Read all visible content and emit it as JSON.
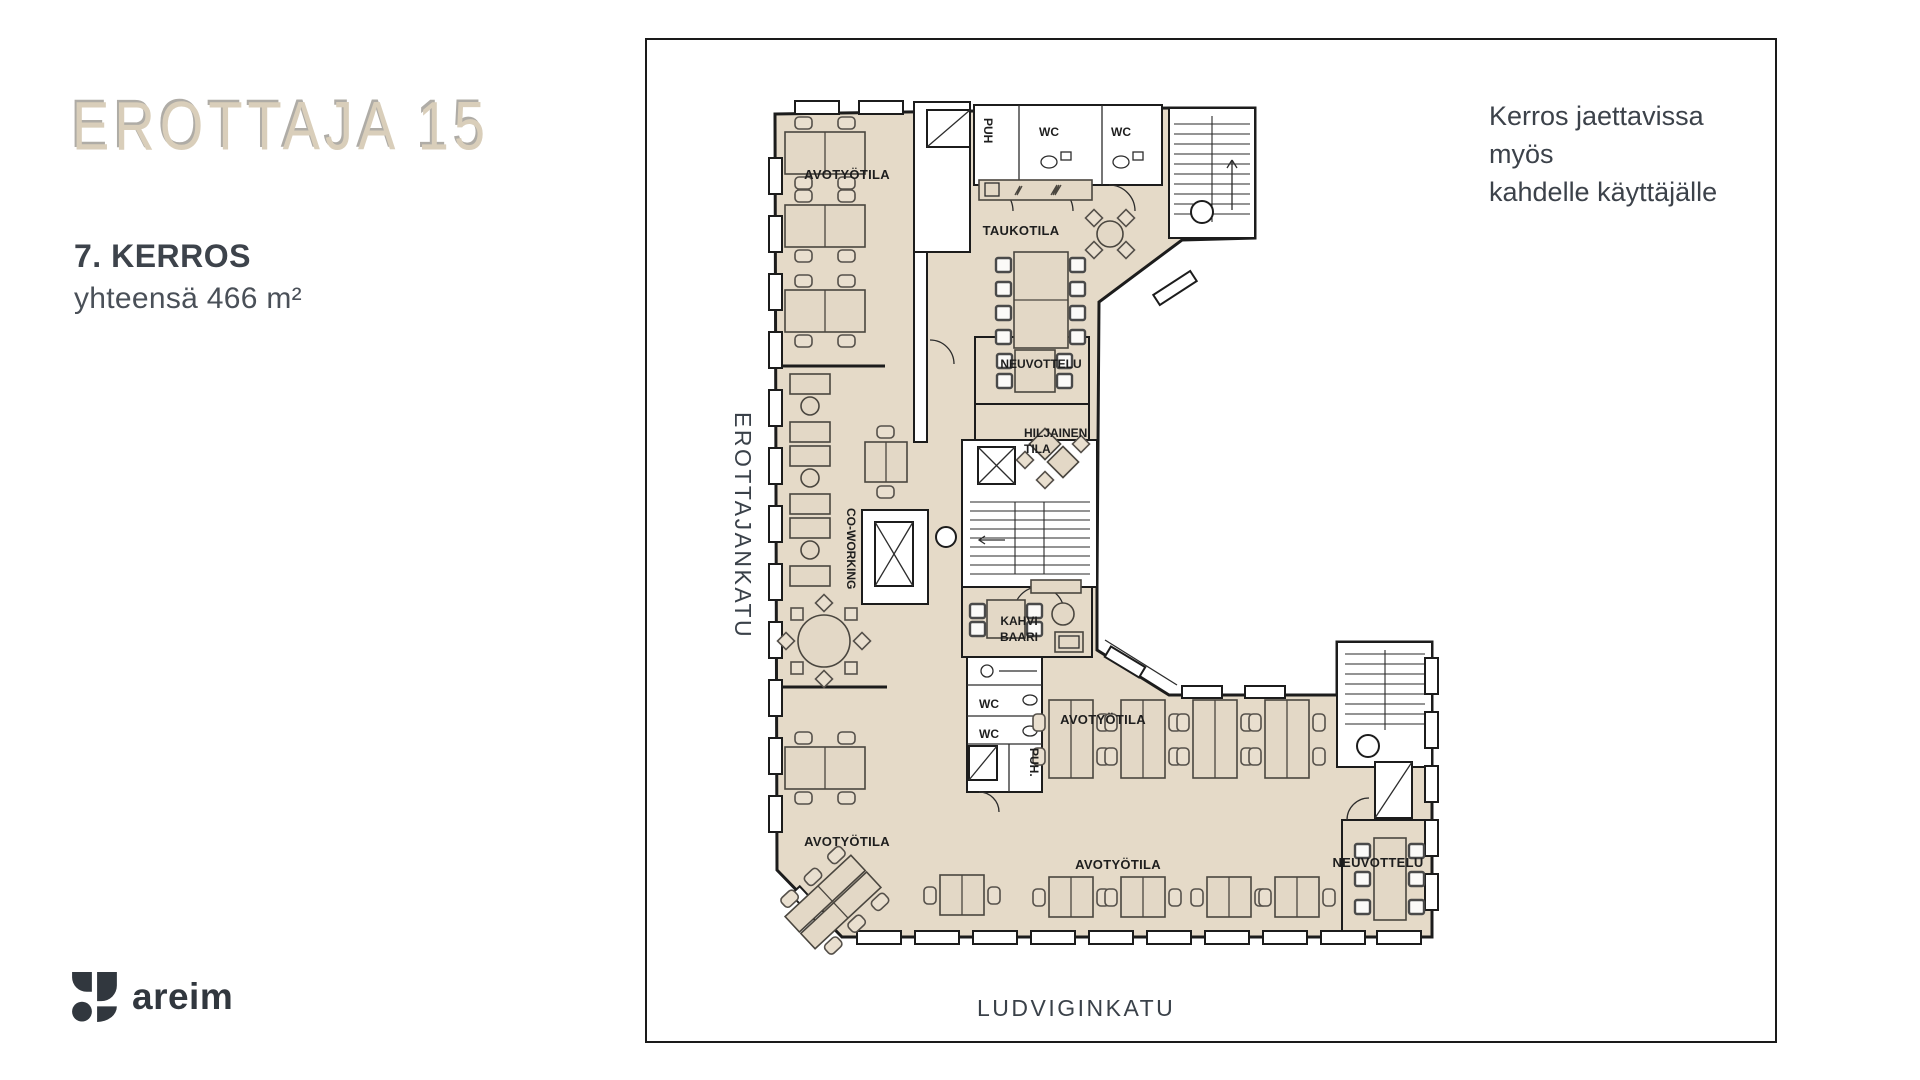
{
  "brand": {
    "title": "EROTTAJA 15"
  },
  "floor": {
    "title": "7. KERROS",
    "area": "yhteensä 466 m²"
  },
  "note": {
    "line1": "Kerros jaettavissa myös",
    "line2": "kahdelle käyttäjälle"
  },
  "logo": {
    "name": "areim"
  },
  "plan": {
    "streets": {
      "left": "EROTTAJANKATU",
      "bottom": "LUDVIGINKATU"
    },
    "rooms": {
      "avotyotila_top": "AVOTYÖTILA",
      "taukotila": "TAUKOTILA",
      "neuvottelu_mid": "NEUVOTTELU",
      "hiljainen_1": "HILJAINEN",
      "hiljainen_2": "TILA",
      "coworking": "CO-WORKING",
      "kahvi_1": "KAHVI",
      "kahvi_2": "BAARI",
      "puh_top": "PUH",
      "wc_top_1": "WC",
      "wc_top_2": "WC",
      "wc_mid_1": "WC",
      "wc_mid_2": "WC",
      "puh_mid": "PUH.",
      "avotyotila_mid": "AVOTYÖTILA",
      "avotyotila_bottom_left": "AVOTYÖTILA",
      "avotyotila_bottom_center": "AVOTYÖTILA",
      "neuvottelu_bottom": "NEUVOTTELU"
    },
    "colors": {
      "floor": "#e5dac8",
      "wall": "#1c1c1c",
      "brand_cream": "#d9ceba",
      "text_dark": "#3d434b"
    }
  }
}
